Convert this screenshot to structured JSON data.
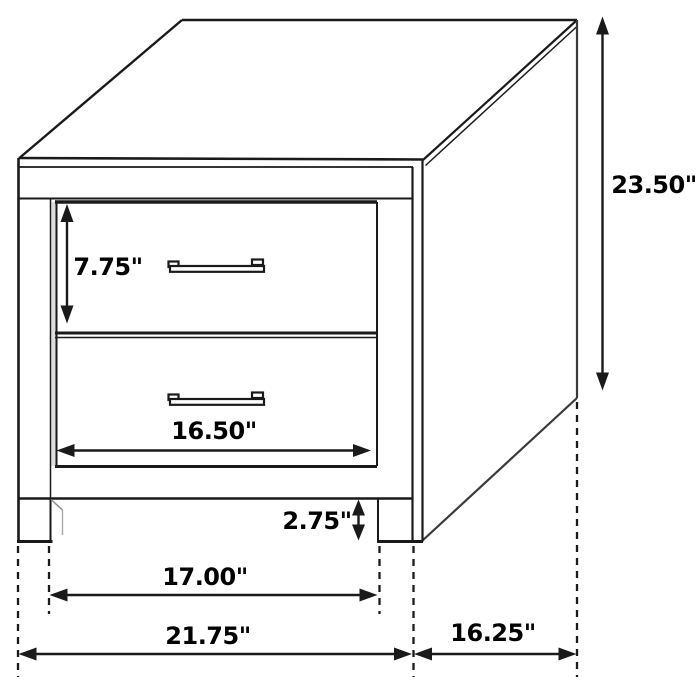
{
  "diagram": {
    "title": "Two-drawer nightstand dimension diagram",
    "units": "inches",
    "colors": {
      "line": "#1a1a1a",
      "background": "#ffffff",
      "text": "#000000",
      "shading": "#dcdcdc"
    },
    "labels": {
      "overall_height": "23.50\"",
      "drawer_height": "7.75\"",
      "drawer_width": "16.50\"",
      "leg_height": "2.75\"",
      "width_between_legs": "17.00\"",
      "overall_width": "21.75\"",
      "depth": "16.25\""
    }
  }
}
